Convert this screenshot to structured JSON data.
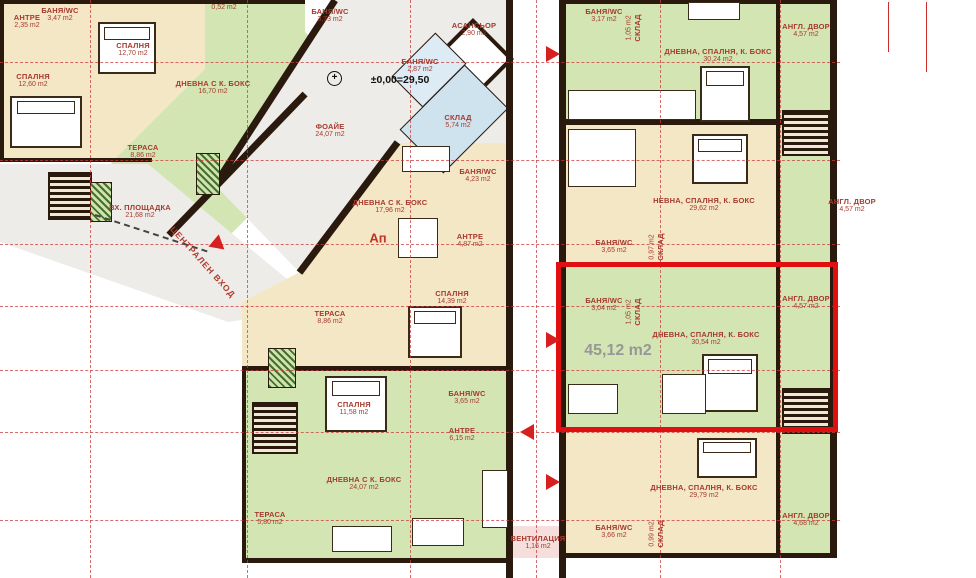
{
  "drawing": {
    "level_mark": "±0,00=29,50",
    "apartment_marker": "Ап",
    "highlighted_apartment_total_area": "45,12 m2",
    "central_entrance_label": "ЦЕНТРАЛЕН ВХОД"
  },
  "colors": {
    "wall": "#2a190d",
    "label_red": "#a63a2e",
    "axis_red": "#cc3b3b",
    "highlight_red": "#e01010",
    "room_beige": "#f4e7c5",
    "room_green": "#d3e5b3",
    "storage_blue": "#cfe3ef",
    "floor_gray": "#edece8"
  },
  "rooms": [
    {
      "name": "АНТРЕ",
      "area": "2,35 m2",
      "x": 27,
      "y": 22
    },
    {
      "name": "БАНЯ/WC",
      "area": "3,47 m2",
      "x": 60,
      "y": 15
    },
    {
      "name": "",
      "area": "0,52 m2",
      "x": 224,
      "y": 8
    },
    {
      "name": "БАНЯ/WC",
      "area": "3,73 m2",
      "x": 330,
      "y": 16
    },
    {
      "name": "АСАНСЬОР",
      "area": "2,90 m2",
      "x": 474,
      "y": 30
    },
    {
      "name": "БАНЯ/WC",
      "area": "2,87 m2",
      "x": 420,
      "y": 66
    },
    {
      "name": "СКЛАД",
      "area": "5,74 m2",
      "x": 458,
      "y": 122
    },
    {
      "name": "СПАЛНЯ",
      "area": "12,70 m2",
      "x": 133,
      "y": 50
    },
    {
      "name": "СПАЛНЯ",
      "area": "12,60 m2",
      "x": 33,
      "y": 81
    },
    {
      "name": "ДНЕВНА С К. БОКС",
      "area": "16,70 m2",
      "x": 213,
      "y": 88
    },
    {
      "name": "ФОАЙЕ",
      "area": "24,07 m2",
      "x": 330,
      "y": 131
    },
    {
      "name": "ТЕРАСА",
      "area": "8,86 m2",
      "x": 143,
      "y": 152
    },
    {
      "name": "ВХ. ПЛОЩАДКА",
      "area": "21,68 m2",
      "x": 140,
      "y": 212
    },
    {
      "name": "ДНЕВНА С К. БОКС",
      "area": "17,96 m2",
      "x": 390,
      "y": 207
    },
    {
      "name": "БАНЯ/WC",
      "area": "4,23 m2",
      "x": 478,
      "y": 176
    },
    {
      "name": "АНТРЕ",
      "area": "4,87 m2",
      "x": 470,
      "y": 241
    },
    {
      "name": "СПАЛНЯ",
      "area": "14,39 m2",
      "x": 452,
      "y": 298
    },
    {
      "name": "ТЕРАСА",
      "area": "8,86 m2",
      "x": 330,
      "y": 318
    },
    {
      "name": "БАНЯ/WC",
      "area": "3,17 m2",
      "x": 604,
      "y": 16
    },
    {
      "name": "СКЛАД",
      "area": "1,05 m2",
      "x": 634,
      "y": 28,
      "vertical": true
    },
    {
      "name": "ДНЕВНА, СПАЛНЯ, К. БОКС",
      "area": "30,24 m2",
      "x": 718,
      "y": 56
    },
    {
      "name": "АНГЛ. ДВОР",
      "area": "4,57 m2",
      "x": 806,
      "y": 31
    },
    {
      "name": "НЕВНА, СПАЛНЯ, К. БОКС",
      "area": "29,62 m2",
      "x": 704,
      "y": 205
    },
    {
      "name": "БАНЯ/WC",
      "area": "3,65 m2",
      "x": 614,
      "y": 247
    },
    {
      "name": "СКЛАД",
      "area": "0,97 m2",
      "x": 657,
      "y": 247,
      "vertical": true
    },
    {
      "name": "АНГЛ. ДВОР",
      "area": "4,57 m2",
      "x": 852,
      "y": 206
    },
    {
      "name": "БАНЯ/WC",
      "area": "3,04 m2",
      "x": 604,
      "y": 305
    },
    {
      "name": "СКЛАД",
      "area": "1,05 m2",
      "x": 634,
      "y": 312,
      "vertical": true
    },
    {
      "name": "ДНЕВНА, СПАЛНЯ, К. БОКС",
      "area": "30,54 m2",
      "x": 706,
      "y": 339
    },
    {
      "name": "АНГЛ. ДВОР",
      "area": "4,57 m2",
      "x": 806,
      "y": 303
    },
    {
      "name": "СПАЛНЯ",
      "area": "11,58 m2",
      "x": 354,
      "y": 409
    },
    {
      "name": "БАНЯ/WC",
      "area": "3,65 m2",
      "x": 467,
      "y": 398
    },
    {
      "name": "АНТРЕ",
      "area": "6,15 m2",
      "x": 462,
      "y": 435
    },
    {
      "name": "ДНЕВНА С К. БОКС",
      "area": "24,07 m2",
      "x": 364,
      "y": 484
    },
    {
      "name": "ТЕРАСА",
      "area": "5,80 m2",
      "x": 270,
      "y": 519
    },
    {
      "name": "ВЕНТИЛАЦИЯ",
      "area": "1,16 m2",
      "x": 538,
      "y": 543
    },
    {
      "name": "ДНЕВНА, СПАЛНЯ, К. БОКС",
      "area": "29,79 m2",
      "x": 704,
      "y": 492
    },
    {
      "name": "БАНЯ/WC",
      "area": "3,66 m2",
      "x": 614,
      "y": 532
    },
    {
      "name": "СКЛАД",
      "area": "0,99 m2",
      "x": 657,
      "y": 534,
      "vertical": true
    },
    {
      "name": "АНГЛ. ДВОР",
      "area": "4,68 m2",
      "x": 806,
      "y": 520
    }
  ],
  "arrows": [
    {
      "x": 546,
      "y": 54,
      "dir": "right"
    },
    {
      "x": 546,
      "y": 340,
      "dir": "right"
    },
    {
      "x": 520,
      "y": 432,
      "dir": "left"
    },
    {
      "x": 546,
      "y": 482,
      "dir": "right"
    },
    {
      "x": 212,
      "y": 245,
      "dir": "right",
      "entrance": true
    }
  ]
}
